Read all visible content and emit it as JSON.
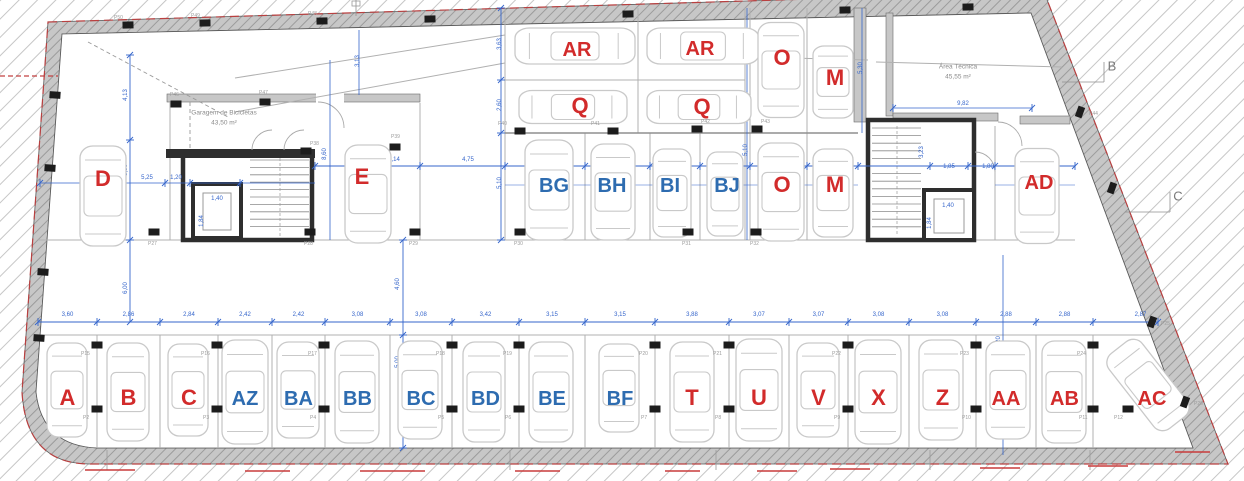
{
  "plan": {
    "colors": {
      "space_red": "#d22b2b",
      "space_blue": "#2e6cb0",
      "dim_blue": "#3565cb",
      "wall_gray": "#c7c7c7",
      "wall_dark": "#2e2e2e",
      "line_gray": "#ababab",
      "car_gray": "#c9c9c9",
      "boundary_red": "#b94040",
      "column_black": "#1c1c1c",
      "plabel_gray": "#9c9c9c"
    },
    "rooms": [
      {
        "name": "bike-garage",
        "label": "Garagem de Bicicletas",
        "area": "43,50 m²",
        "x": 224,
        "y": 118
      },
      {
        "name": "technical-area",
        "label": "Área Técnica",
        "area": "45,55 m²",
        "x": 958,
        "y": 72
      }
    ],
    "grid_markers": [
      {
        "label": "B",
        "x": 1112,
        "y": 66
      },
      {
        "label": "C",
        "x": 1178,
        "y": 196
      }
    ],
    "spaces_bottom": [
      {
        "id": "A",
        "color": "red",
        "l": 38,
        "r": 97,
        "dim": "3,60",
        "car": [
          67,
          390,
          40,
          94,
          0
        ]
      },
      {
        "id": "B",
        "color": "red",
        "l": 97,
        "r": 160,
        "dim": "2,86",
        "car": [
          128,
          392,
          42,
          98,
          0
        ]
      },
      {
        "id": "C",
        "color": "red",
        "l": 160,
        "r": 218,
        "dim": "2,84",
        "car": [
          188,
          390,
          40,
          92,
          0
        ]
      },
      {
        "id": "AZ",
        "color": "blue",
        "l": 218,
        "r": 272,
        "dim": "2,42",
        "car": [
          245,
          392,
          46,
          104,
          0
        ]
      },
      {
        "id": "BA",
        "color": "blue",
        "l": 272,
        "r": 325,
        "dim": "2,42",
        "car": [
          298,
          390,
          42,
          96,
          0
        ]
      },
      {
        "id": "BB",
        "color": "blue",
        "l": 325,
        "r": 390,
        "dim": "3,08",
        "car": [
          357,
          392,
          44,
          102,
          0
        ]
      },
      {
        "id": "BC",
        "color": "blue",
        "l": 390,
        "r": 452,
        "dim": "3,08",
        "car": [
          420,
          390,
          44,
          98,
          0
        ]
      },
      {
        "id": "BD",
        "color": "blue",
        "l": 452,
        "r": 519,
        "dim": "3,42",
        "car": [
          484,
          392,
          42,
          100,
          0
        ]
      },
      {
        "id": "BE",
        "color": "blue",
        "l": 519,
        "r": 585,
        "dim": "3,15",
        "car": [
          551,
          392,
          44,
          100,
          0
        ]
      },
      {
        "id": "BF",
        "color": "blue",
        "l": 585,
        "r": 655,
        "dim": "3,15",
        "car": [
          619,
          388,
          40,
          88,
          0
        ]
      },
      {
        "id": "T",
        "color": "red",
        "l": 655,
        "r": 729,
        "dim": "3,88",
        "car": [
          692,
          392,
          44,
          100,
          0
        ]
      },
      {
        "id": "U",
        "color": "red",
        "l": 729,
        "r": 789,
        "dim": "3,07",
        "car": [
          759,
          390,
          46,
          102,
          0
        ]
      },
      {
        "id": "V",
        "color": "red",
        "l": 789,
        "r": 848,
        "dim": "3,07",
        "car": [
          818,
          390,
          42,
          94,
          0
        ]
      },
      {
        "id": "X",
        "color": "red",
        "l": 848,
        "r": 909,
        "dim": "3,08",
        "car": [
          878,
          392,
          46,
          104,
          0
        ]
      },
      {
        "id": "Z",
        "color": "red",
        "l": 909,
        "r": 976,
        "dim": "3,08",
        "car": [
          941,
          390,
          44,
          100,
          0
        ]
      },
      {
        "id": "AA",
        "color": "red",
        "l": 976,
        "r": 1036,
        "dim": "2,88",
        "car": [
          1008,
          390,
          44,
          98,
          0
        ]
      },
      {
        "id": "AB",
        "color": "red",
        "l": 1036,
        "r": 1093,
        "dim": "2,88",
        "car": [
          1064,
          392,
          44,
          102,
          0
        ]
      },
      {
        "id": "AC",
        "color": "red",
        "l": 1093,
        "r": 1188,
        "dim": "2,87",
        "label_x": 1152,
        "car": [
          1148,
          385,
          42,
          95,
          -38
        ]
      }
    ],
    "spaces_middle": [
      {
        "id": "D",
        "color": "red",
        "x": 103,
        "y": 179,
        "car": [
          103,
          196,
          46,
          100,
          0
        ]
      },
      {
        "id": "E",
        "color": "red",
        "x": 362,
        "y": 177,
        "car": [
          368,
          194,
          46,
          98,
          0
        ]
      },
      {
        "id": "BG",
        "color": "blue",
        "x": 554,
        "y": 185,
        "car": [
          549,
          190,
          48,
          100,
          0
        ]
      },
      {
        "id": "BH",
        "color": "blue",
        "x": 612,
        "y": 185,
        "car": [
          613,
          192,
          44,
          96,
          0
        ]
      },
      {
        "id": "BI",
        "color": "blue",
        "x": 670,
        "y": 185,
        "car": [
          672,
          193,
          38,
          88,
          0
        ]
      },
      {
        "id": "BJ",
        "color": "blue",
        "x": 727,
        "y": 185,
        "car": [
          725,
          194,
          36,
          84,
          0
        ]
      },
      {
        "id": "O",
        "color": "red",
        "x": 782,
        "y": 185,
        "car": [
          781,
          192,
          46,
          98,
          0
        ]
      },
      {
        "id": "M",
        "color": "red",
        "x": 835,
        "y": 185,
        "car": [
          833,
          193,
          40,
          88,
          0
        ]
      },
      {
        "id": "AD",
        "color": "red",
        "x": 1039,
        "y": 182,
        "car": [
          1037,
          196,
          44,
          95,
          0
        ]
      }
    ],
    "spaces_top": [
      {
        "id": "AR",
        "color": "red",
        "x": 577,
        "y": 49,
        "car": [
          575,
          46,
          36,
          120,
          90
        ]
      },
      {
        "id": "AR",
        "color": "red",
        "x": 700,
        "y": 48,
        "car": [
          703,
          46,
          36,
          112,
          90
        ]
      },
      {
        "id": "Q",
        "color": "red",
        "x": 580,
        "y": 106,
        "car": [
          573,
          107,
          33,
          108,
          90
        ]
      },
      {
        "id": "Q",
        "color": "red",
        "x": 702,
        "y": 107,
        "car": [
          699,
          107,
          33,
          104,
          90
        ]
      },
      {
        "id": "O",
        "color": "red",
        "x": 782,
        "y": 58,
        "car": [
          781,
          70,
          46,
          95,
          0
        ]
      },
      {
        "id": "M",
        "color": "red",
        "x": 835,
        "y": 78,
        "car": [
          833,
          82,
          40,
          72,
          0
        ]
      }
    ],
    "h_dims": [
      [
        "5,25",
        147,
        179
      ],
      [
        "1,20",
        176,
        179
      ],
      [
        "5,14",
        394,
        161
      ],
      [
        "4,75",
        468,
        161
      ],
      [
        "5,30",
        545,
        161
      ],
      [
        "3,08",
        617,
        161
      ],
      [
        "2,40",
        675,
        161
      ],
      [
        "2,40",
        725,
        161
      ],
      [
        "2,60",
        779,
        162
      ],
      [
        "2,65",
        833,
        162
      ],
      [
        "1,85",
        949,
        168
      ],
      [
        "1,80",
        988,
        168
      ],
      [
        "4,48",
        1043,
        169
      ],
      [
        "9,82",
        963,
        105
      ],
      [
        "1,40",
        217,
        200
      ],
      [
        "1,40",
        948,
        207
      ]
    ],
    "v_dims": [
      [
        "4,13",
        127,
        95
      ],
      [
        "5,50",
        127,
        170
      ],
      [
        "6,00",
        127,
        288
      ],
      [
        "3,13",
        359,
        61
      ],
      [
        "8,60",
        326,
        154
      ],
      [
        "3,63",
        501,
        44
      ],
      [
        "2,60",
        501,
        105
      ],
      [
        "5,10",
        501,
        183
      ],
      [
        "3,05",
        747,
        47
      ],
      [
        "5,10",
        747,
        150
      ],
      [
        "5,30",
        862,
        68
      ],
      [
        "3,23",
        923,
        152
      ],
      [
        "4,60",
        399,
        284
      ],
      [
        "5,00",
        399,
        362
      ],
      [
        "5,20",
        1000,
        342
      ],
      [
        "2,50",
        1000,
        398
      ],
      [
        "1,84",
        203,
        221
      ],
      [
        "1,84",
        931,
        223
      ]
    ],
    "columns": [
      [
        128,
        25,
        -1,
        "P50",
        -14,
        -6
      ],
      [
        205,
        23,
        -1,
        "P49",
        -14,
        -6
      ],
      [
        322,
        21,
        -1,
        "P48",
        -14,
        -6
      ],
      [
        430,
        19,
        -1,
        "",
        0,
        0
      ],
      [
        628,
        14,
        -1,
        "",
        0,
        0
      ],
      [
        845,
        10,
        -1,
        "",
        0,
        0
      ],
      [
        968,
        7,
        -1,
        "",
        0,
        0
      ],
      [
        55,
        95,
        4,
        "",
        0,
        0
      ],
      [
        50,
        168,
        4,
        "",
        0,
        0
      ],
      [
        43,
        272,
        4,
        "",
        0,
        0
      ],
      [
        39,
        338,
        4,
        "",
        0,
        0
      ],
      [
        1080,
        112,
        20,
        "P44",
        9,
        3
      ],
      [
        1112,
        188,
        20,
        "",
        0,
        0
      ],
      [
        1152,
        322,
        20,
        "P25",
        9,
        3
      ],
      [
        1185,
        402,
        20,
        "P26",
        9,
        3
      ],
      [
        176,
        104,
        0,
        "P46",
        -6,
        -8
      ],
      [
        265,
        102,
        0,
        "P47",
        -6,
        -8
      ],
      [
        306,
        151,
        0,
        "P38",
        4,
        -6
      ],
      [
        395,
        147,
        0,
        "P39",
        -4,
        -9
      ],
      [
        520,
        131,
        0,
        "P40",
        -22,
        -6
      ],
      [
        613,
        131,
        0,
        "P41",
        -22,
        -6
      ],
      [
        697,
        129,
        0,
        "P42",
        4,
        -6
      ],
      [
        757,
        129,
        0,
        "P43",
        4,
        -6
      ],
      [
        154,
        232,
        0,
        "P27",
        -6,
        13
      ],
      [
        310,
        232,
        0,
        "P28",
        -6,
        13
      ],
      [
        415,
        232,
        0,
        "P29",
        -6,
        13
      ],
      [
        520,
        232,
        0,
        "P30",
        -6,
        13
      ],
      [
        688,
        232,
        0,
        "P31",
        -6,
        13
      ],
      [
        756,
        232,
        0,
        "P32",
        -6,
        13
      ],
      [
        97,
        345,
        0,
        "P15",
        -16,
        10
      ],
      [
        217,
        345,
        0,
        "P16",
        -16,
        10
      ],
      [
        324,
        345,
        0,
        "P17",
        -16,
        10
      ],
      [
        452,
        345,
        0,
        "P18",
        -16,
        10
      ],
      [
        519,
        345,
        0,
        "P19",
        -16,
        10
      ],
      [
        655,
        345,
        0,
        "P20",
        -16,
        10
      ],
      [
        729,
        345,
        0,
        "P21",
        -16,
        10
      ],
      [
        848,
        345,
        0,
        "P22",
        -16,
        10
      ],
      [
        976,
        345,
        0,
        "P23",
        -16,
        10
      ],
      [
        1093,
        345,
        0,
        "P24",
        -16,
        10
      ],
      [
        97,
        409,
        0,
        "P2",
        -14,
        10
      ],
      [
        217,
        409,
        0,
        "P3",
        -14,
        10
      ],
      [
        324,
        409,
        0,
        "P4",
        -14,
        10
      ],
      [
        452,
        409,
        0,
        "P5",
        -14,
        10
      ],
      [
        519,
        409,
        0,
        "P6",
        -14,
        10
      ],
      [
        655,
        409,
        0,
        "P7",
        -14,
        10
      ],
      [
        729,
        409,
        0,
        "P8",
        -14,
        10
      ],
      [
        848,
        409,
        0,
        "P9",
        -14,
        10
      ],
      [
        976,
        409,
        0,
        "P10",
        -14,
        10
      ],
      [
        1093,
        409,
        0,
        "P11",
        -14,
        10
      ],
      [
        1128,
        409,
        0,
        "P12",
        -14,
        10
      ]
    ],
    "red_dashes": [
      [
        85,
        470,
        50
      ],
      [
        245,
        471,
        45
      ],
      [
        360,
        471,
        65
      ],
      [
        515,
        471,
        45
      ],
      [
        665,
        471,
        35
      ],
      [
        757,
        471,
        40
      ],
      [
        830,
        469,
        40
      ],
      [
        980,
        468,
        40
      ],
      [
        1088,
        466,
        40
      ],
      [
        1175,
        452,
        35
      ]
    ]
  }
}
